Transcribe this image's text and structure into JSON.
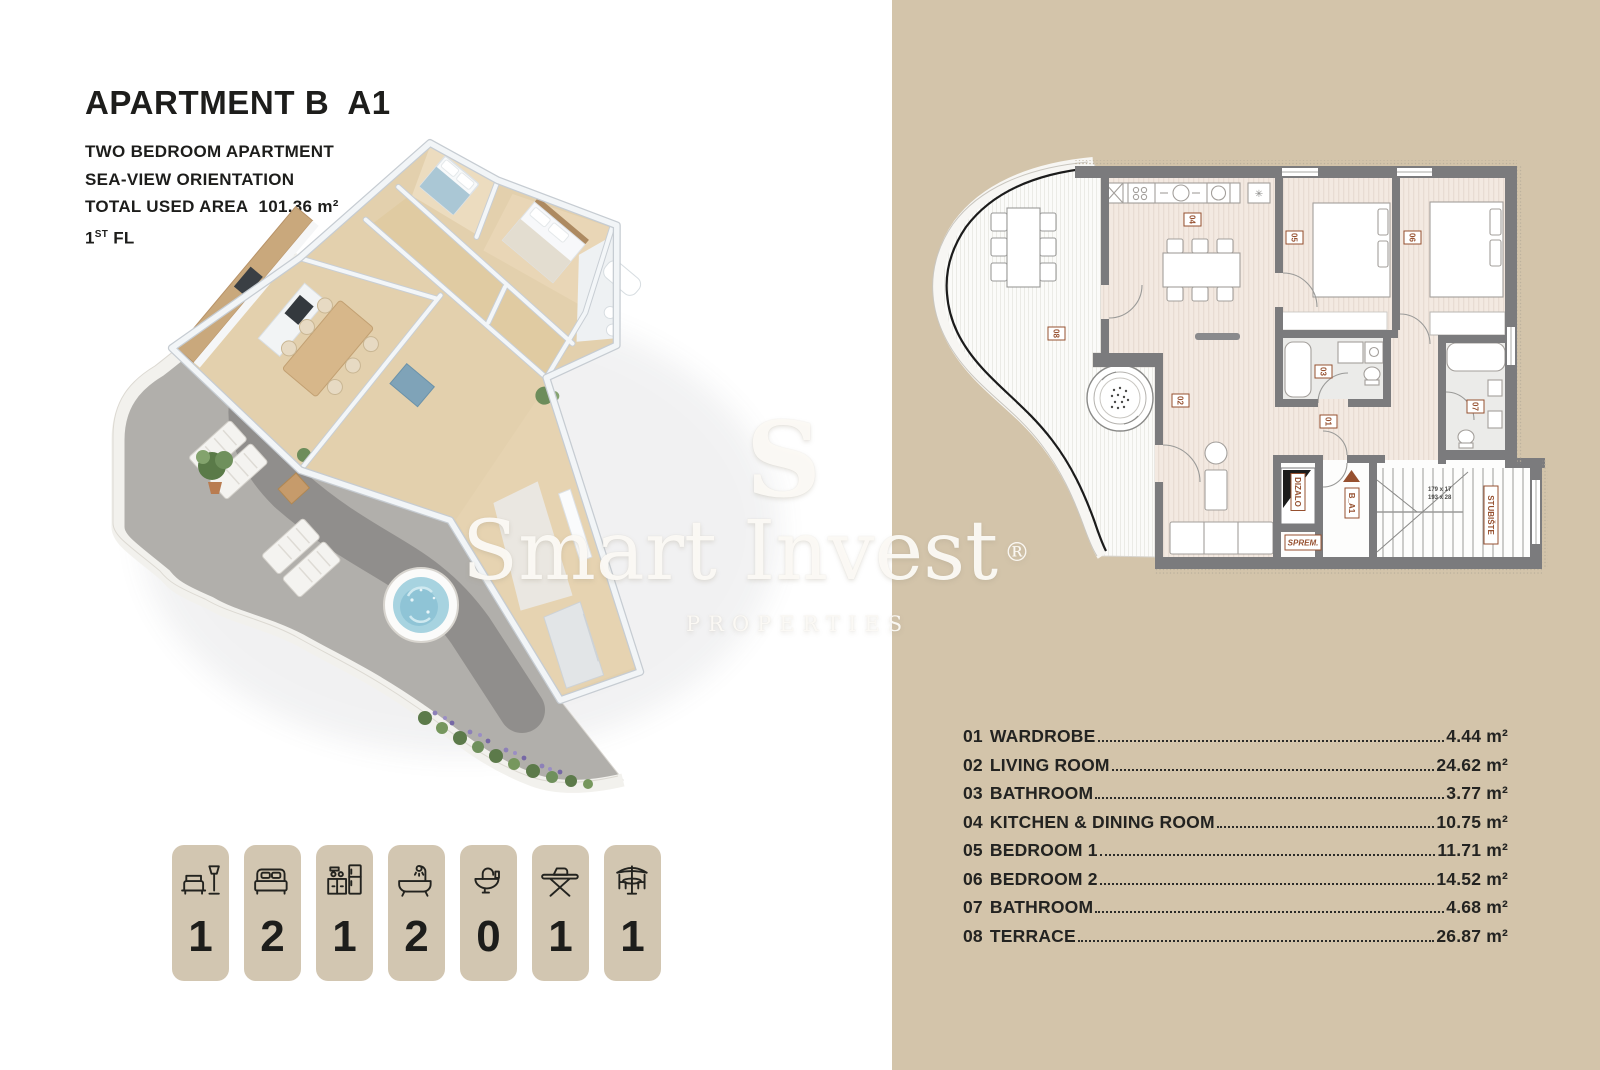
{
  "page": {
    "panel_color": "#d3c4aa",
    "badge_color": "#d2c6b1",
    "accent_brown": "#96502f",
    "text_color": "#1f1f1d"
  },
  "header": {
    "title_main": "APARTMENT B",
    "title_unit": "A1",
    "subtitle_line1": "TWO BEDROOM APARTMENT",
    "subtitle_line2": "SEA-VIEW ORIENTATION",
    "area_label": "TOTAL USED AREA",
    "area_value": "101.36 m²",
    "floor_number": "1",
    "floor_suffix": "ST",
    "floor_label": "FL"
  },
  "watermark": {
    "initial": "S",
    "name": "Smart Invest",
    "registered": "®",
    "tagline": "PROPERTIES"
  },
  "badges": {
    "items": [
      {
        "icon": "sofa-lamp-icon",
        "count": "1"
      },
      {
        "icon": "double-bed-icon",
        "count": "2"
      },
      {
        "icon": "kitchen-icon",
        "count": "1"
      },
      {
        "icon": "bathtub-icon",
        "count": "2"
      },
      {
        "icon": "washbasin-icon",
        "count": "0"
      },
      {
        "icon": "ironing-board-icon",
        "count": "1"
      },
      {
        "icon": "patio-table-icon",
        "count": "1"
      }
    ]
  },
  "rooms": {
    "list": [
      {
        "number": "01",
        "name": "WARDROBE",
        "area": "4.44 m²"
      },
      {
        "number": "02",
        "name": "LIVING ROOM",
        "area": "24.62 m²"
      },
      {
        "number": "03",
        "name": "BATHROOM",
        "area": "3.77 m²"
      },
      {
        "number": "04",
        "name": "KITCHEN & DINING ROOM",
        "area": "10.75 m²"
      },
      {
        "number": "05",
        "name": "BEDROOM 1",
        "area": "11.71 m²"
      },
      {
        "number": "06",
        "name": "BEDROOM 2",
        "area": "14.52 m²"
      },
      {
        "number": "07",
        "name": "BATHROOM",
        "area": "4.68 m²"
      },
      {
        "number": "08",
        "name": "TERRACE",
        "area": "26.87 m²"
      }
    ]
  },
  "floorplan2d": {
    "labels": {
      "wardrobe": "01",
      "living": "02",
      "bathroom1": "03",
      "kitchen": "04",
      "bedroom1": "05",
      "bedroom2": "06",
      "bathroom2": "07",
      "terrace": "08",
      "elevator": "DIZALO",
      "unit": "B_A1",
      "storage": "SPREM.",
      "staircase": "STUBIŠTE",
      "stair_dim_1": "179 x 17",
      "stair_dim_2": "193 x 28",
      "vent_symbol": "✳"
    }
  }
}
